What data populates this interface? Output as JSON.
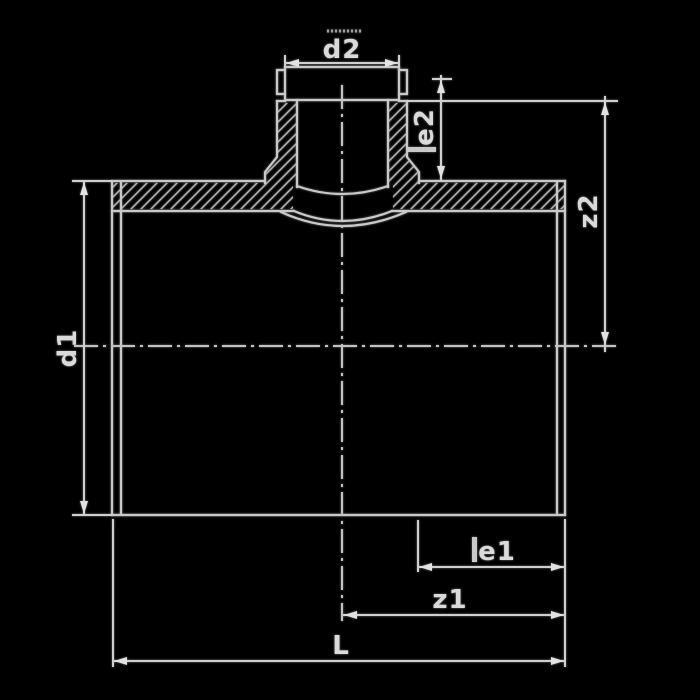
{
  "drawing": {
    "description": "Technical cross-section drawing of a reducing tee / saddle pipe fitting with dimension callouts",
    "colors": {
      "background": "#000000",
      "line": "#c9c9c9",
      "hatch": "#b5b5b5",
      "text": "#dadada",
      "arrow": "#e2e2e2"
    },
    "labels": {
      "d2": "d2",
      "e2": "e2",
      "z2": "z2",
      "d1": "d1",
      "e1": "e1",
      "z1": "z1",
      "L": "L"
    }
  }
}
